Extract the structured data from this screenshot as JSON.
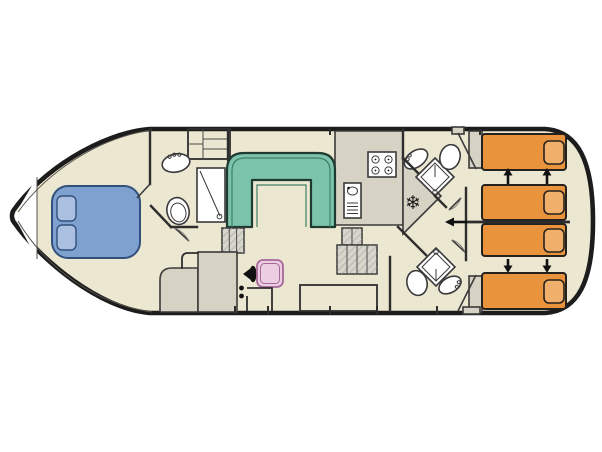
{
  "plan": {
    "type": "boat-deck-floor-plan",
    "orientation": "bow-left-stern-right",
    "areas": [
      {
        "name": "bow-cabin",
        "features": [
          "double-bed",
          "two-pillows"
        ]
      },
      {
        "name": "fore-bathroom",
        "features": [
          "washbasin",
          "toilet",
          "shower"
        ]
      },
      {
        "name": "foredeck-steps",
        "features": [
          "companionway-steps"
        ]
      },
      {
        "name": "saloon",
        "features": [
          "u-shaped-sofa",
          "helm-console",
          "steering-wheel",
          "helm-seat",
          "side-chest",
          "steps-to-aft-deck"
        ]
      },
      {
        "name": "galley",
        "features": [
          "four-burner-hob",
          "sink-with-drainer",
          "fridge-freezer"
        ]
      },
      {
        "name": "aft-bathroom-top",
        "features": [
          "corner-shower",
          "washbasin",
          "toilet"
        ]
      },
      {
        "name": "aft-bathroom-bottom",
        "features": [
          "corner-shower",
          "washbasin",
          "toilet"
        ]
      },
      {
        "name": "aft-cabin-top",
        "features": [
          "two-single-beds",
          "slide-together-arrows",
          "wardrobe"
        ]
      },
      {
        "name": "aft-cabin-bottom",
        "features": [
          "two-single-beds",
          "slide-together-arrows",
          "wardrobe"
        ]
      }
    ],
    "bed_count": {
      "double": 1,
      "single": 4
    }
  },
  "icons": {
    "snowflake": "❄"
  },
  "colors": {
    "background": "#ffffff",
    "hull_outline": "#1c1c1c",
    "wall": "#2d2d2d",
    "floor": "#ece7d1",
    "galley_gray": "#d6d3c4",
    "furniture_gray": "#d6d3c4",
    "stairs_gray": "#d8d6ca",
    "sofa_fill": "#7cc3ab",
    "sofa_border": "#1f3b31",
    "sofa_inner": "#3f8066",
    "bed_blue_fill": "#7fa1cf",
    "bed_blue_border": "#31517c",
    "pillow_blue_fill": "#abc0e1",
    "bed_orange_fill": "#e9933c",
    "bed_orange_border": "#25221d",
    "pillow_orange_fill": "#f0b06b",
    "helm_seat_fill": "#eccde1",
    "helm_seat_border": "#a6699a",
    "fixture_fill": "#ffffff",
    "fixture_stroke": "#3a3a3a",
    "arrow": "#111111"
  }
}
